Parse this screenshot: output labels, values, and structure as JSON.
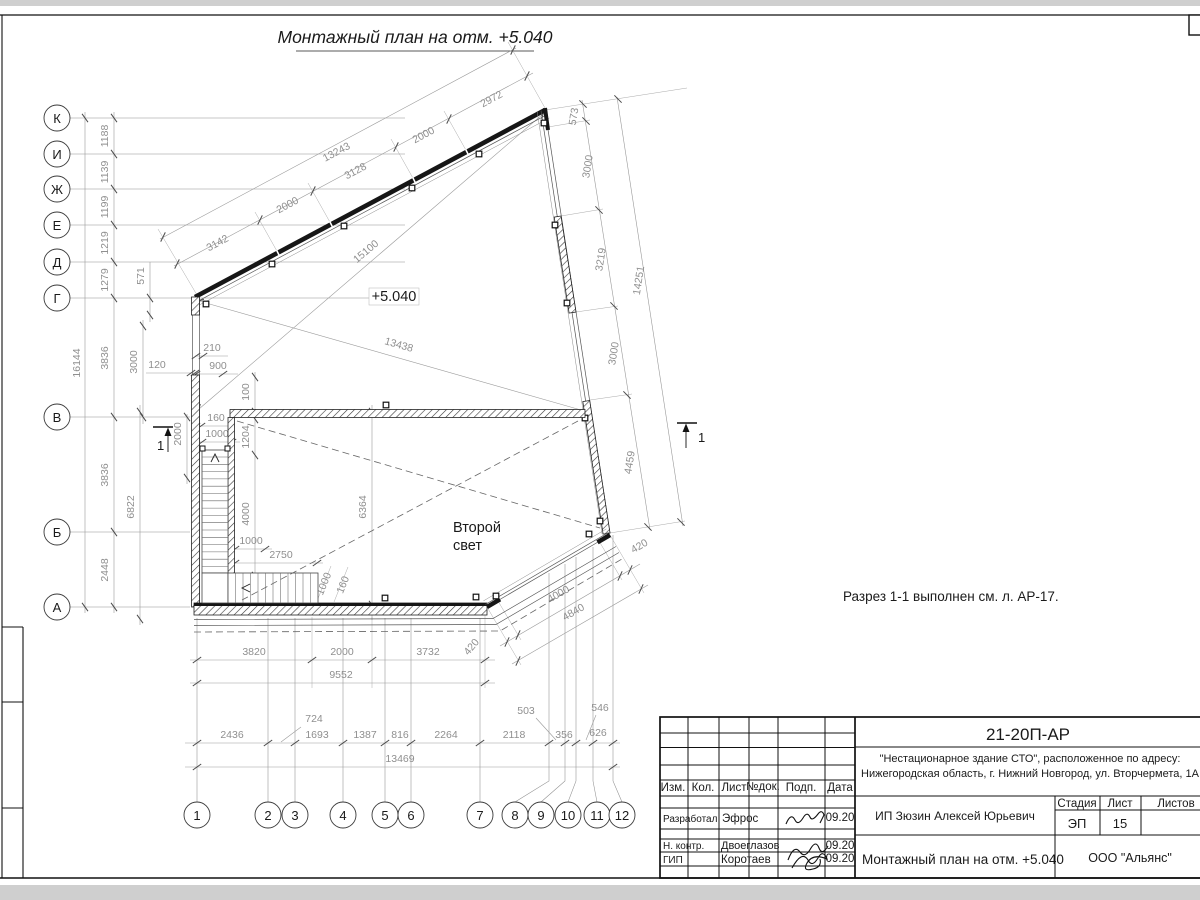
{
  "sheet": {
    "page_title": "Монтажный план на отм. +5.040",
    "note": "Разрез 1-1 выполнен см. л. АР-17.",
    "elevation_mark": "+5.040",
    "void_label_line1": "Второй",
    "void_label_line2": "свет",
    "section_label": "1"
  },
  "axes": {
    "rows": [
      "К",
      "И",
      "Ж",
      "Е",
      "Д",
      "Г",
      "В",
      "Б",
      "А"
    ],
    "cols": [
      "1",
      "2",
      "3",
      "4",
      "5",
      "6",
      "7",
      "8",
      "9",
      "10",
      "11",
      "12"
    ]
  },
  "dims": {
    "top_chain": [
      "3142",
      "2000",
      "3128",
      "2000",
      "2972"
    ],
    "top_total": "13243",
    "diagonals": [
      "15100",
      "13438"
    ],
    "left_chain": [
      "1188",
      "1139",
      "1199",
      "1219",
      "1279",
      "3836",
      "3836",
      "2448"
    ],
    "left_total": "16144",
    "left_aux": [
      "571",
      "3000",
      "6822",
      "2000",
      "120"
    ],
    "right_chain": [
      "573",
      "3000",
      "3219",
      "3000",
      "4459"
    ],
    "right_total": "14251",
    "bottom_chain": [
      "3820",
      "2000",
      "3732"
    ],
    "bottom_total": "9552",
    "skew_chain": [
      "420",
      "4000",
      "420"
    ],
    "skew_total": "4840",
    "axis_chain": [
      "2436",
      "724",
      "1693",
      "1387",
      "816",
      "2264",
      "2118",
      "503",
      "356",
      "546",
      "626"
    ],
    "axis_total": "13469",
    "interior": [
      "210",
      "900",
      "100",
      "160",
      "1000",
      "1204",
      "4000",
      "1000",
      "2750",
      "6364",
      "1000",
      "160"
    ]
  },
  "title_block": {
    "code": "21-20П-АР",
    "project_line1": "\"Нестационарное здание СТО\", расположенное по адресу:",
    "project_line2": "Нижегородская область, г. Нижний Новгород, ул. Вторчермета, 1А",
    "client": "ИП Зюзин Алексей Юрьевич",
    "doc_title": "Монтажный план на отм. +5.040",
    "company": "ООО \"Альянс\"",
    "cols": [
      "Изм.",
      "Кол.",
      "Лист",
      "№док.",
      "Подп.",
      "Дата"
    ],
    "stage_label": "Стадия",
    "sheet_label": "Лист",
    "sheets_label": "Листов",
    "stage": "ЭП",
    "sheet_no": "15",
    "rows": [
      {
        "role": "Разработал",
        "name": "Эфрос",
        "date": "09.20"
      },
      {
        "role": "Н. контр.",
        "name": "Двоеглазов",
        "date": "09.20"
      },
      {
        "role": "ГИП",
        "name": "Коротаев",
        "date": "09.20"
      }
    ]
  }
}
